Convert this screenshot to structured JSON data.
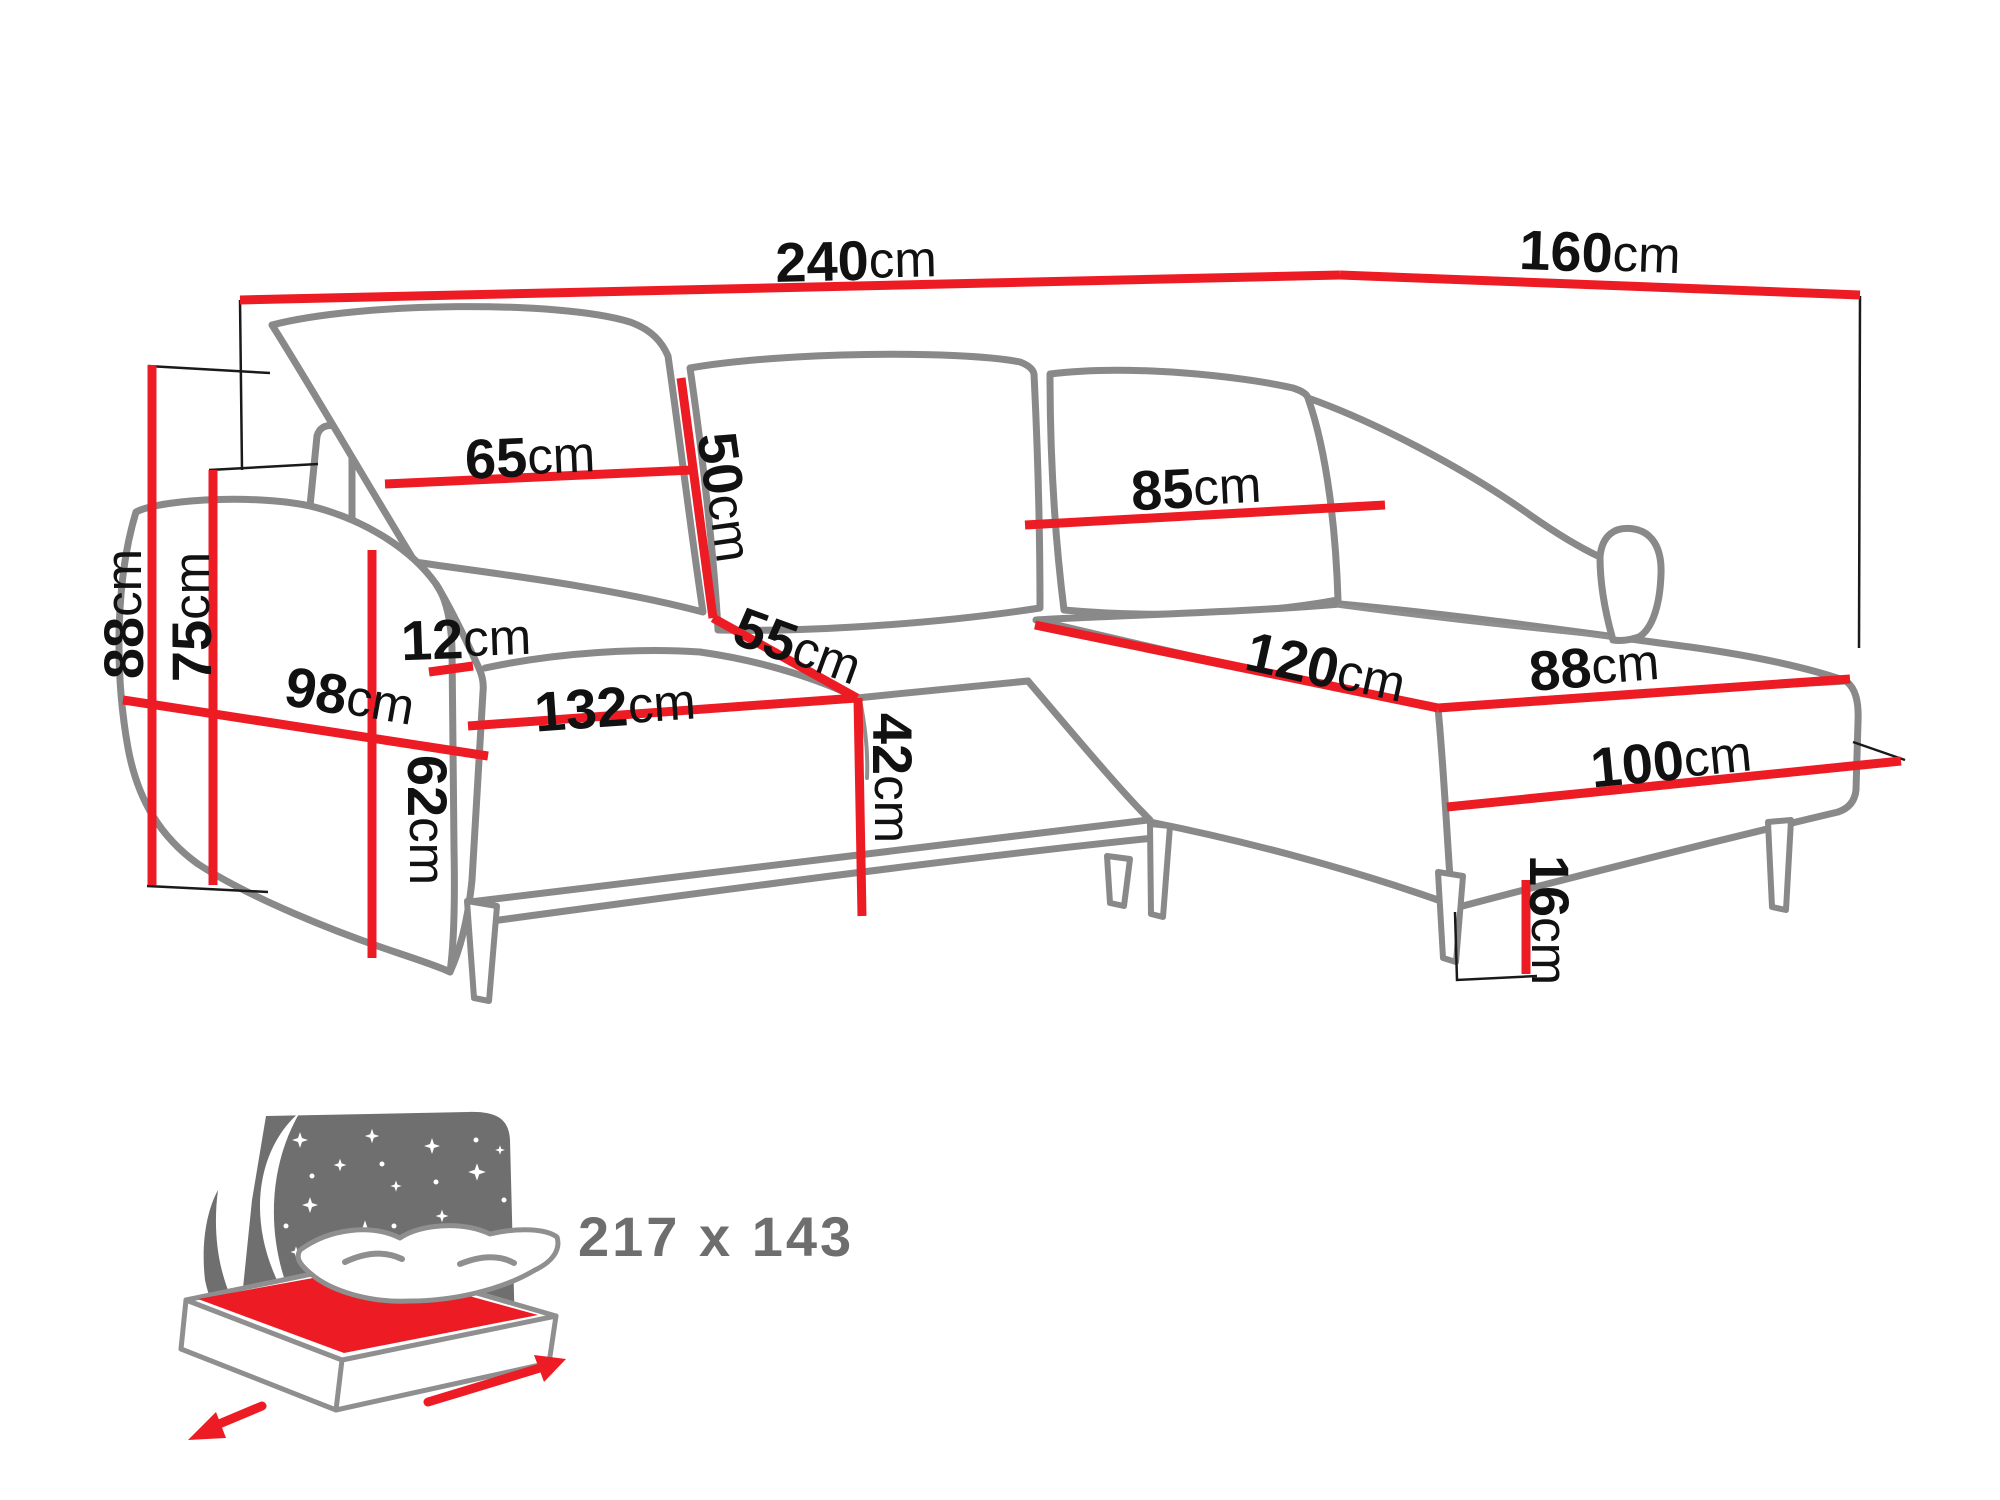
{
  "diagram_type": "corner-sofa-dimensions",
  "colors": {
    "dimension_line_red": "#ed1c24",
    "sofa_outline_gray": "#898989",
    "helper_line_black": "#1a1a1a",
    "label_text_black": "#111111",
    "icon_panel_gray": "#6f6f6f",
    "bed_size_text_gray": "#6e6e6e",
    "background": "#ffffff"
  },
  "dims": {
    "d240": {
      "num": "240",
      "unit": "cm"
    },
    "d160": {
      "num": "160",
      "unit": "cm"
    },
    "d88": {
      "num": "88",
      "unit": "cm"
    },
    "d75": {
      "num": "75",
      "unit": "cm"
    },
    "d65": {
      "num": "65",
      "unit": "cm"
    },
    "d50": {
      "num": "50",
      "unit": "cm"
    },
    "d55": {
      "num": "55",
      "unit": "cm"
    },
    "d12": {
      "num": "12",
      "unit": "cm"
    },
    "d98": {
      "num": "98",
      "unit": "cm"
    },
    "d62": {
      "num": "62",
      "unit": "cm"
    },
    "d132": {
      "num": "132",
      "unit": "cm"
    },
    "d42": {
      "num": "42",
      "unit": "cm"
    },
    "d85": {
      "num": "85",
      "unit": "cm"
    },
    "d120": {
      "num": "120",
      "unit": "cm"
    },
    "d88c": {
      "num": "88",
      "unit": "cm"
    },
    "d100": {
      "num": "100",
      "unit": "cm"
    },
    "d16": {
      "num": "16",
      "unit": "cm"
    }
  },
  "sleeping_area": {
    "size": "217 x 143"
  }
}
